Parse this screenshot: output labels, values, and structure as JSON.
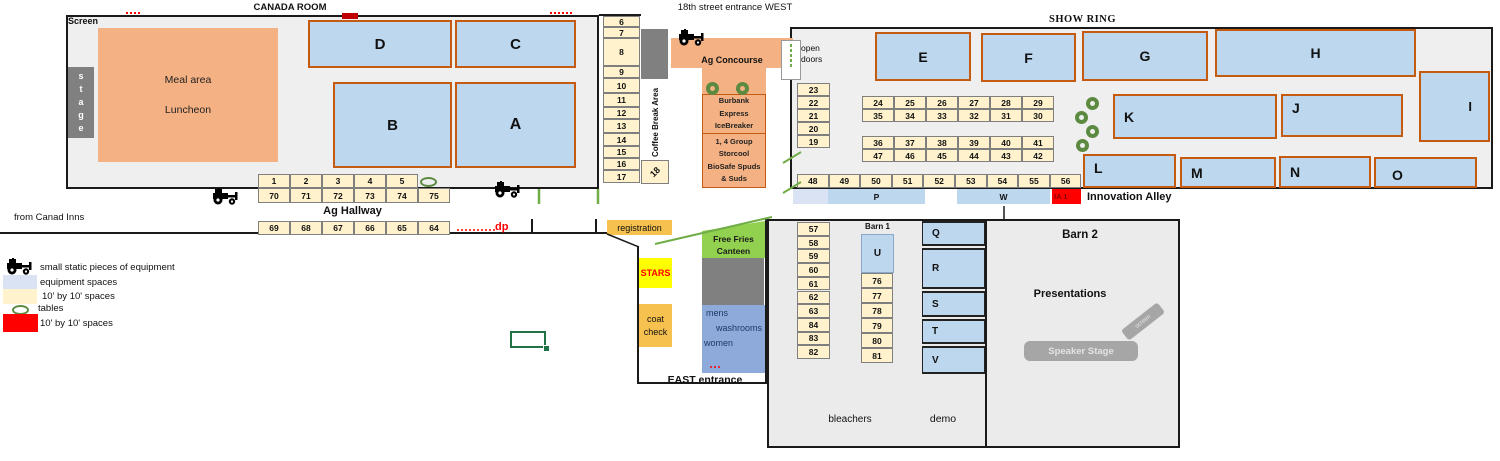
{
  "titles": {
    "canada_room": "CANADA ROOM",
    "west_entrance": "18th street entrance WEST",
    "show_ring": "SHOW RING"
  },
  "canada_room": {
    "screen": "Screen",
    "stage_letters": [
      "s",
      "t",
      "a",
      "g",
      "e"
    ],
    "meal": [
      "Meal area",
      "Luncheon"
    ]
  },
  "concourse": {
    "label": "Ag Concourse",
    "open_doors": [
      "open",
      "doors"
    ],
    "coffee_break": "Coffee Break Area",
    "cell18": "18",
    "burbank": [
      "Burbank",
      "Express",
      "IceBreaker"
    ],
    "storcool": [
      "1, 4 Group",
      "Storcool",
      "BioSafe Spuds",
      "& Suds"
    ]
  },
  "hallway": {
    "label": "Ag Hallway",
    "dp": "dp",
    "from": "from Canad Inns"
  },
  "east": {
    "registration": "registration",
    "stars": "STARS",
    "coat_check": [
      "coat",
      "check"
    ],
    "canteen": [
      "Free Fries",
      "Canteen"
    ],
    "washrooms": [
      "mens",
      "washrooms",
      "women"
    ],
    "entrance": "EAST entrance"
  },
  "alley": {
    "p": "P",
    "w": "W",
    "ia1": "IA 1",
    "label": "Innovation Alley"
  },
  "barn": {
    "barn1": "Barn 1",
    "barn2": "Barn 2",
    "presentations": "Presentations",
    "speaker_stage": "Speaker Stage",
    "screen": "screen",
    "bleachers": "bleachers",
    "demo": "demo"
  },
  "legend": {
    "items": [
      {
        "kind": "tractor",
        "label": "small static pieces of equipment",
        "x": 4,
        "y": 258,
        "lx": 40,
        "ly": 262
      },
      {
        "kind": "swatch",
        "color": "#dae3f3",
        "label": "equipment spaces",
        "x": 3,
        "y": 275,
        "w": 34,
        "h": 14,
        "lx": 40,
        "ly": 277
      },
      {
        "kind": "swatch",
        "color": "#fff2cc",
        "label": "10' by 10' spaces",
        "x": 3,
        "y": 289,
        "w": 34,
        "h": 15,
        "lx": 42,
        "ly": 291
      },
      {
        "kind": "oval",
        "label": "tables",
        "x": 12,
        "y": 305,
        "lx": 38,
        "ly": 303
      },
      {
        "kind": "swatch",
        "color": "#ff0000",
        "label": "10' by 10' spaces",
        "x": 3,
        "y": 314,
        "w": 35,
        "h": 18,
        "lx": 40,
        "ly": 318
      }
    ]
  },
  "colors": {
    "equipment_space_fill": "#bdd7ee",
    "block_border": "#c55a11",
    "ten_by_ten_fill": "#fff2cc",
    "red_space": "#ff0000",
    "table_green": "#5d8a41",
    "orange_area": "#f4b183"
  },
  "blocks": [
    {
      "t": "D",
      "x": 308,
      "y": 20,
      "w": 144,
      "h": 48,
      "c": "blue",
      "a": "c",
      "fs": 15
    },
    {
      "t": "C",
      "x": 455,
      "y": 20,
      "w": 121,
      "h": 48,
      "c": "blue",
      "a": "c",
      "fs": 15
    },
    {
      "t": "B",
      "x": 333,
      "y": 82,
      "w": 119,
      "h": 86,
      "c": "blue",
      "a": "c",
      "fs": 15
    },
    {
      "t": "A",
      "x": 455,
      "y": 82,
      "w": 121,
      "h": 86,
      "c": "blue",
      "a": "c",
      "fs": 16
    },
    {
      "t": "E",
      "x": 875,
      "y": 32,
      "w": 96,
      "h": 49,
      "c": "blue",
      "a": "c",
      "fs": 14
    },
    {
      "t": "F",
      "x": 981,
      "y": 33,
      "w": 95,
      "h": 49,
      "c": "blue",
      "a": "c",
      "fs": 14
    },
    {
      "t": "G",
      "x": 1082,
      "y": 31,
      "w": 126,
      "h": 50,
      "c": "blue",
      "a": "c",
      "fs": 14
    },
    {
      "t": "H",
      "x": 1215,
      "y": 29,
      "w": 201,
      "h": 48,
      "c": "blue",
      "a": "c",
      "fs": 14
    },
    {
      "t": "I",
      "x": 1419,
      "y": 71,
      "w": 71,
      "h": 71,
      "c": "blue",
      "a": "rl",
      "fs": 13
    },
    {
      "t": "K",
      "x": 1113,
      "y": 94,
      "w": 164,
      "h": 45,
      "c": "blue",
      "a": "l",
      "fs": 14
    },
    {
      "t": "J",
      "x": 1281,
      "y": 94,
      "w": 122,
      "h": 43,
      "c": "blue",
      "a": "tl",
      "fs": 14
    },
    {
      "t": "L",
      "x": 1083,
      "y": 154,
      "w": 93,
      "h": 34,
      "c": "blue",
      "a": "tl",
      "fs": 14
    },
    {
      "t": "M",
      "x": 1180,
      "y": 157,
      "w": 96,
      "h": 31,
      "c": "blue",
      "a": "l",
      "fs": 14
    },
    {
      "t": "N",
      "x": 1279,
      "y": 156,
      "w": 92,
      "h": 32,
      "c": "blue",
      "a": "l",
      "fs": 14
    },
    {
      "t": "O",
      "x": 1374,
      "y": 157,
      "w": 103,
      "h": 31,
      "c": "blue",
      "a": "bl",
      "fs": 14
    },
    {
      "t": "U",
      "x": 861,
      "y": 234,
      "w": 33,
      "h": 39,
      "c": "blue2",
      "a": "c",
      "fs": 10
    },
    {
      "t": "Q",
      "x": 922,
      "y": 221,
      "w": 63,
      "h": 25,
      "c": "blue3",
      "a": "l",
      "fs": 10
    },
    {
      "t": "R",
      "x": 922,
      "y": 248,
      "w": 63,
      "h": 41,
      "c": "blue3",
      "a": "l",
      "fs": 10
    },
    {
      "t": "S",
      "x": 922,
      "y": 291,
      "w": 63,
      "h": 26,
      "c": "blue3",
      "a": "l",
      "fs": 10
    },
    {
      "t": "T",
      "x": 922,
      "y": 319,
      "w": 63,
      "h": 25,
      "c": "blue3",
      "a": "l",
      "fs": 10
    },
    {
      "t": "V",
      "x": 922,
      "y": 346,
      "w": 63,
      "h": 28,
      "c": "blue3",
      "a": "l",
      "fs": 10
    }
  ],
  "cell_rows": [
    {
      "x": 258,
      "y": 174,
      "w": 32,
      "h": 14,
      "values": [
        "1",
        "2",
        "3",
        "4",
        "5"
      ]
    },
    {
      "x": 258,
      "y": 188,
      "w": 32,
      "h": 15,
      "values": [
        "70",
        "71",
        "72",
        "73",
        "74",
        "75"
      ]
    },
    {
      "x": 258,
      "y": 221,
      "w": 32,
      "h": 14,
      "values": [
        "69",
        "68",
        "67",
        "66",
        "65",
        "64"
      ]
    },
    {
      "x": 862,
      "y": 96,
      "w": 32,
      "h": 13,
      "values": [
        "24",
        "25",
        "26",
        "27",
        "28",
        "29"
      ]
    },
    {
      "x": 862,
      "y": 109,
      "w": 32,
      "h": 13,
      "values": [
        "35",
        "34",
        "33",
        "32",
        "31",
        "30"
      ]
    },
    {
      "x": 862,
      "y": 136,
      "w": 32,
      "h": 13,
      "values": [
        "36",
        "37",
        "38",
        "39",
        "40",
        "41"
      ]
    },
    {
      "x": 862,
      "y": 149,
      "w": 32,
      "h": 13,
      "values": [
        "47",
        "46",
        "45",
        "44",
        "43",
        "42"
      ]
    },
    {
      "x": 797,
      "y": 174,
      "w": 31.6,
      "h": 14,
      "values": [
        "48",
        "49",
        "50",
        "51",
        "52",
        "53",
        "54",
        "55",
        "56"
      ]
    },
    {
      "x": 797,
      "y": 83,
      "w": 33,
      "h": 13,
      "vert": true,
      "values": [
        "23",
        "22",
        "21",
        "20",
        "19"
      ]
    },
    {
      "x": 797,
      "y": 222,
      "w": 33,
      "h": 13.7,
      "vert": true,
      "values": [
        "57",
        "58",
        "59",
        "60",
        "61",
        "62",
        "63",
        "84",
        "83",
        "82"
      ]
    },
    {
      "x": 861,
      "y": 273,
      "w": 32,
      "h": 15,
      "vert": true,
      "values": [
        "76",
        "77",
        "78",
        "79",
        "80",
        "81"
      ]
    }
  ],
  "col617": {
    "x": 603,
    "w": 37,
    "cells": [
      [
        "6",
        16,
        11
      ],
      [
        "7",
        27,
        11
      ],
      [
        "8",
        38,
        28
      ],
      [
        "9",
        66,
        12
      ],
      [
        "10",
        78,
        15
      ],
      [
        "11",
        93,
        14
      ],
      [
        "12",
        107,
        12
      ],
      [
        "13",
        119,
        14
      ],
      [
        "14",
        133,
        13
      ],
      [
        "15",
        146,
        12
      ],
      [
        "16",
        158,
        12
      ],
      [
        "17",
        170,
        13
      ]
    ]
  },
  "tables": {
    "donuts": [
      [
        706,
        82
      ],
      [
        736,
        82
      ],
      [
        1086,
        97
      ],
      [
        1075,
        111
      ],
      [
        1086,
        125
      ],
      [
        1076,
        139
      ]
    ],
    "ovals": [
      [
        420,
        177
      ]
    ]
  },
  "equipment": [
    [
      210,
      188
    ],
    [
      492,
      181
    ],
    [
      676,
      29
    ]
  ],
  "lines": [
    {
      "n": "wall-diagonal",
      "x1": 607,
      "y1": 234,
      "x2": 639,
      "y2": 247,
      "s": "#1a1a1a",
      "w": 1.5
    },
    {
      "n": "innovation-alley-pointer",
      "x1": 1004,
      "y1": 206,
      "x2": 1004,
      "y2": 219,
      "s": "#1a1a1a",
      "w": 1.5
    },
    {
      "n": "hallway-tick",
      "x1": 532,
      "y1": 219,
      "x2": 532,
      "y2": 232,
      "s": "#1a1a1a",
      "w": 2
    },
    {
      "n": "hallway-tick",
      "x1": 596,
      "y1": 219,
      "x2": 596,
      "y2": 232,
      "s": "#1a1a1a",
      "w": 2
    },
    {
      "n": "green-tick",
      "x1": 539,
      "y1": 189,
      "x2": 539,
      "y2": 204,
      "s": "#70ad47",
      "w": 2.5
    },
    {
      "n": "green-tick",
      "x1": 598,
      "y1": 189,
      "x2": 598,
      "y2": 204,
      "s": "#70ad47",
      "w": 2.5
    },
    {
      "n": "green-diagonal",
      "x1": 655,
      "y1": 244,
      "x2": 772,
      "y2": 217,
      "s": "#70ad47",
      "w": 2
    },
    {
      "n": "green-mark",
      "x1": 783,
      "y1": 163,
      "x2": 801,
      "y2": 152,
      "s": "#70ad47",
      "w": 2
    },
    {
      "n": "green-mark",
      "x1": 783,
      "y1": 193,
      "x2": 801,
      "y2": 182,
      "s": "#70ad47",
      "w": 2
    },
    {
      "n": "red-dotted",
      "x1": 457,
      "y1": 230,
      "x2": 496,
      "y2": 230,
      "s": "#ff0000",
      "w": 1.5,
      "d": "2 2"
    },
    {
      "n": "red-dotted",
      "x1": 710,
      "y1": 367,
      "x2": 722,
      "y2": 367,
      "s": "#ff0000",
      "w": 1.5,
      "d": "2 2"
    },
    {
      "n": "red-dotted",
      "x1": 550,
      "y1": 13,
      "x2": 574,
      "y2": 13,
      "s": "#ff0000",
      "w": 2,
      "d": "2 2"
    },
    {
      "n": "red-dotted",
      "x1": 126,
      "y1": 13,
      "x2": 140,
      "y2": 13,
      "s": "#ff0000",
      "w": 2,
      "d": "2 2"
    },
    {
      "n": "open-door-dashes",
      "x1": 791,
      "y1": 44,
      "x2": 791,
      "y2": 68,
      "s": "#70ad47",
      "w": 2,
      "d": "3 2"
    }
  ]
}
